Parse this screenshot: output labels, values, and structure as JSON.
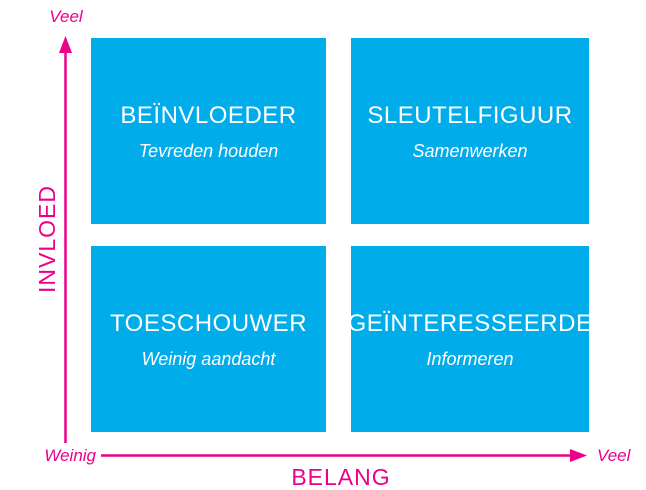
{
  "quadrants": [
    {
      "position": "top-left",
      "title": "BEÏNVLOEDER",
      "subtitle": "Tevreden houden"
    },
    {
      "position": "top-right",
      "title": "SLEUTELFIGUUR",
      "subtitle": "Samenwerken"
    },
    {
      "position": "bottom-left",
      "title": "TOESCHOUWER",
      "subtitle": "Weinig aandacht"
    },
    {
      "position": "bottom-right",
      "title": "GEÏNTERESSEERDE",
      "subtitle": "Informeren"
    }
  ],
  "axes": {
    "y": {
      "title": "INVLOED",
      "top_label": "Veel"
    },
    "x": {
      "title": "BELANG",
      "left_label": "Weinig",
      "right_label": "Veel"
    }
  },
  "colors": {
    "quadrant_fill": "#00ACEA",
    "quadrant_text": "#FFFFFF",
    "axis": "#EC008C",
    "background": "#FFFFFF"
  }
}
